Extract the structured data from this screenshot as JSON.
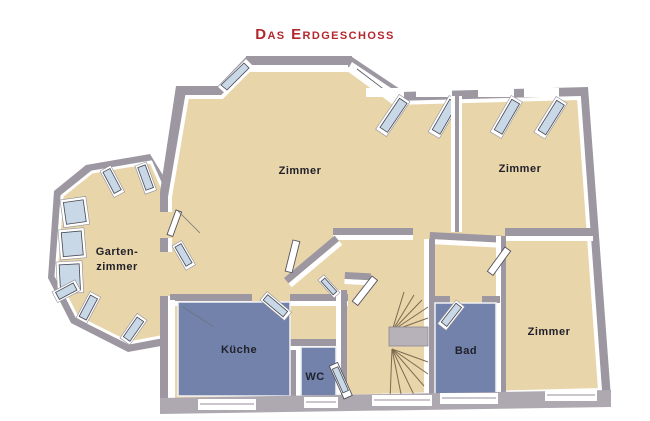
{
  "title": "Das Erdgeschoss",
  "colors": {
    "background": "#ffffff",
    "title": "#b3282f",
    "floor_beige": "#e9d5aa",
    "floor_blue": "#7282ab",
    "wall": "#9d97a1",
    "wall_light": "#aea8b0",
    "wall_face": "#ffffff",
    "glass": "#c9d8e6",
    "frame": "#45454f",
    "label_ink": "#21212b",
    "landing": "#b7b1b9",
    "tread": "#7d6a50"
  },
  "rooms": [
    {
      "id": "zimmer-top-left",
      "label": "Zimmer",
      "floor": "beige"
    },
    {
      "id": "zimmer-top-right",
      "label": "Zimmer",
      "floor": "beige"
    },
    {
      "id": "gartenzimmer",
      "label_line1": "Garten-",
      "label_line2": "zimmer",
      "floor": "beige"
    },
    {
      "id": "kueche",
      "label": "Küche",
      "floor": "blue"
    },
    {
      "id": "wc",
      "label": "WC",
      "floor": "blue"
    },
    {
      "id": "bad",
      "label": "Bad",
      "floor": "blue"
    },
    {
      "id": "zimmer-bottom-right",
      "label": "Zimmer",
      "floor": "beige"
    }
  ]
}
